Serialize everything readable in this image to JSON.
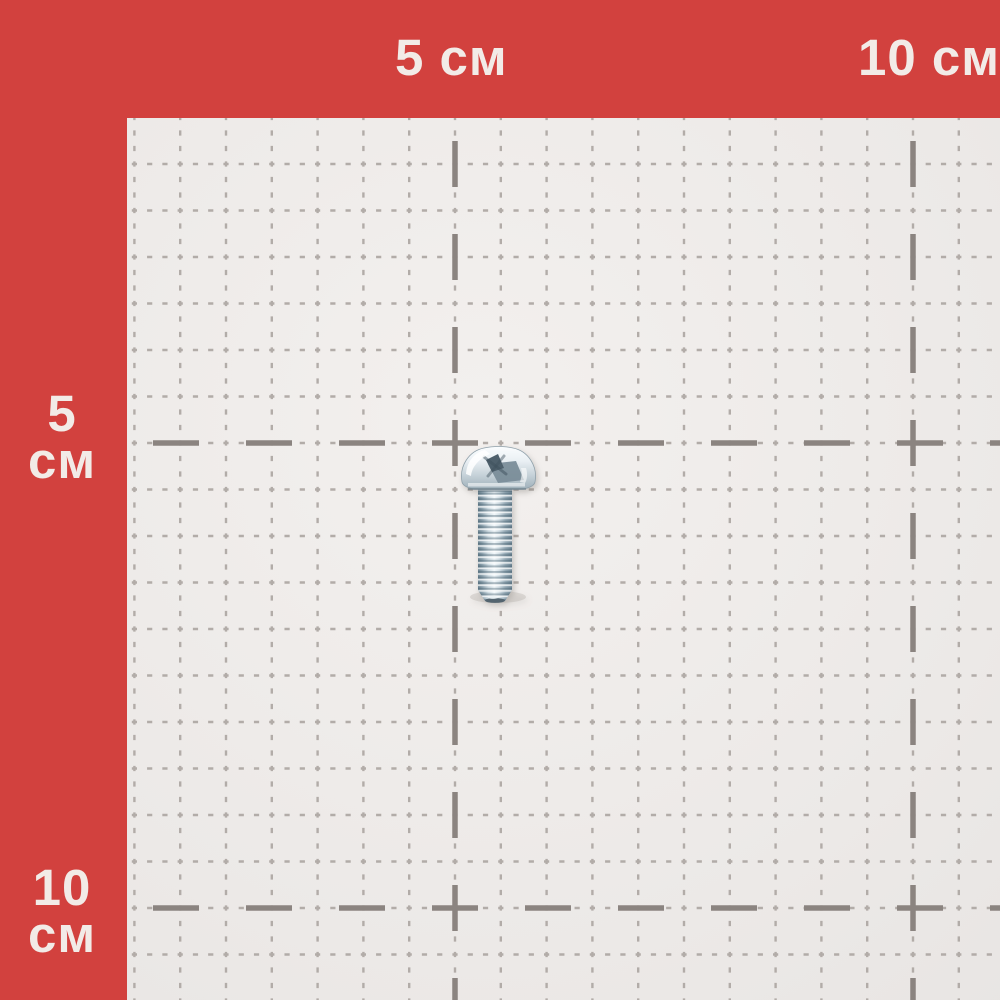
{
  "subject": {
    "type": "pan-head-screw",
    "description": "zinc-plated pan head screw with cross recess lying on a centimeter measurement grid"
  },
  "ruler": {
    "unit": "см",
    "top_labels": [
      {
        "text": "5 см",
        "position_cm": 5
      },
      {
        "text": "10 см",
        "position_cm": 10
      }
    ],
    "left_labels": [
      {
        "line1": "5",
        "line2": "см",
        "position_cm": 5
      },
      {
        "line1": "10",
        "line2": "см",
        "position_cm": 10
      }
    ]
  },
  "grid": {
    "area": {
      "left": 127,
      "top": 118,
      "right": 1000,
      "bottom": 1000
    },
    "minor_spacing_x": 45.8,
    "minor_spacing_y": 46.5,
    "bold_vertical_x": [
      455,
      913
    ],
    "bold_horizontal_y": [
      443,
      908
    ],
    "bold_dash": 46,
    "bold_gap": 47,
    "minor_dash": 5.2,
    "minor_line_width": 2.4,
    "bold_line_width": 5.5
  },
  "colors": {
    "border_red": "#d2413e",
    "label_text": "#f2ebe7",
    "paper": "#ece9e7",
    "paper_light": "#f3f0ee",
    "paper_dark": "#e2dfdd",
    "grid_minor": "#b2aca8",
    "grid_bold": "#8b8480",
    "screw_metal_light": "#f1f7fa",
    "screw_metal_mid": "#c2d2da",
    "screw_metal_dark": "#6b8290"
  }
}
